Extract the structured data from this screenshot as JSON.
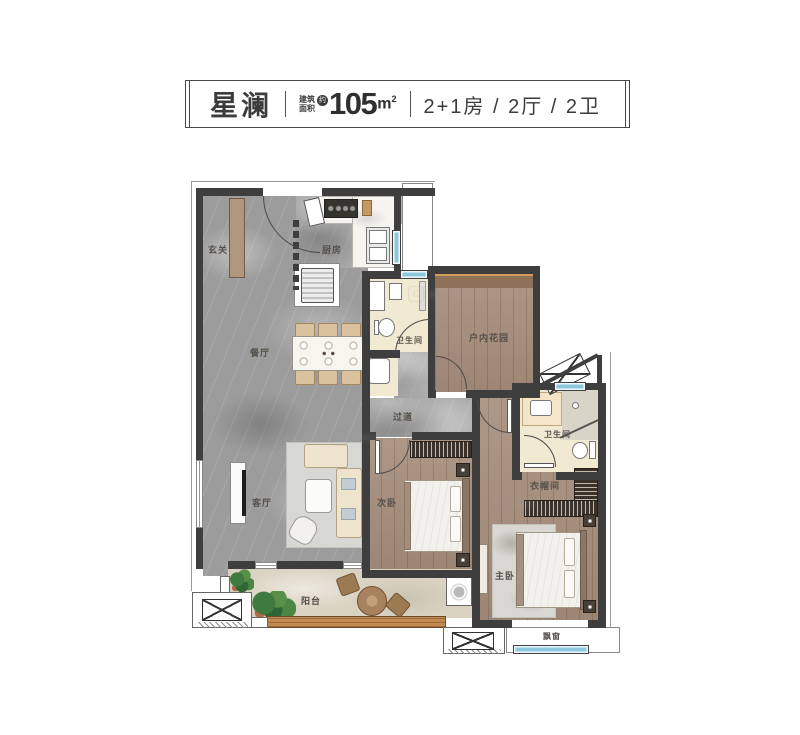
{
  "header": {
    "title": "星澜",
    "area_prefix_line1": "建筑",
    "area_prefix_line2": "面积",
    "area_approx": "约",
    "area_value": "105",
    "area_unit": "m",
    "area_sup": "2",
    "layout_text": "2+1房 / 2厅 / 2卫"
  },
  "rooms": {
    "entry": "玄关",
    "kitchen": "厨房",
    "dining": "餐厅",
    "bath1": "卫生间",
    "garden": "户内花园",
    "hallway": "过道",
    "bedroom2": "次卧",
    "living": "客厅",
    "bath2": "卫生间",
    "cloakroom": "衣帽间",
    "master": "主卧",
    "balcony": "阳台",
    "bay_window": "飘窗"
  },
  "watermark": {
    "text": "C"
  },
  "colors": {
    "wall": "#3e3e3e",
    "window_glass": "#8cc7dd",
    "marble_floor": "#9c9c9c",
    "wood_floor": "#a68e7c",
    "bath_floor": "#f1e9d2",
    "balcony_floor": "#dad3c2",
    "deck_wood": "#c08a50",
    "text": "#3b3b3b"
  }
}
